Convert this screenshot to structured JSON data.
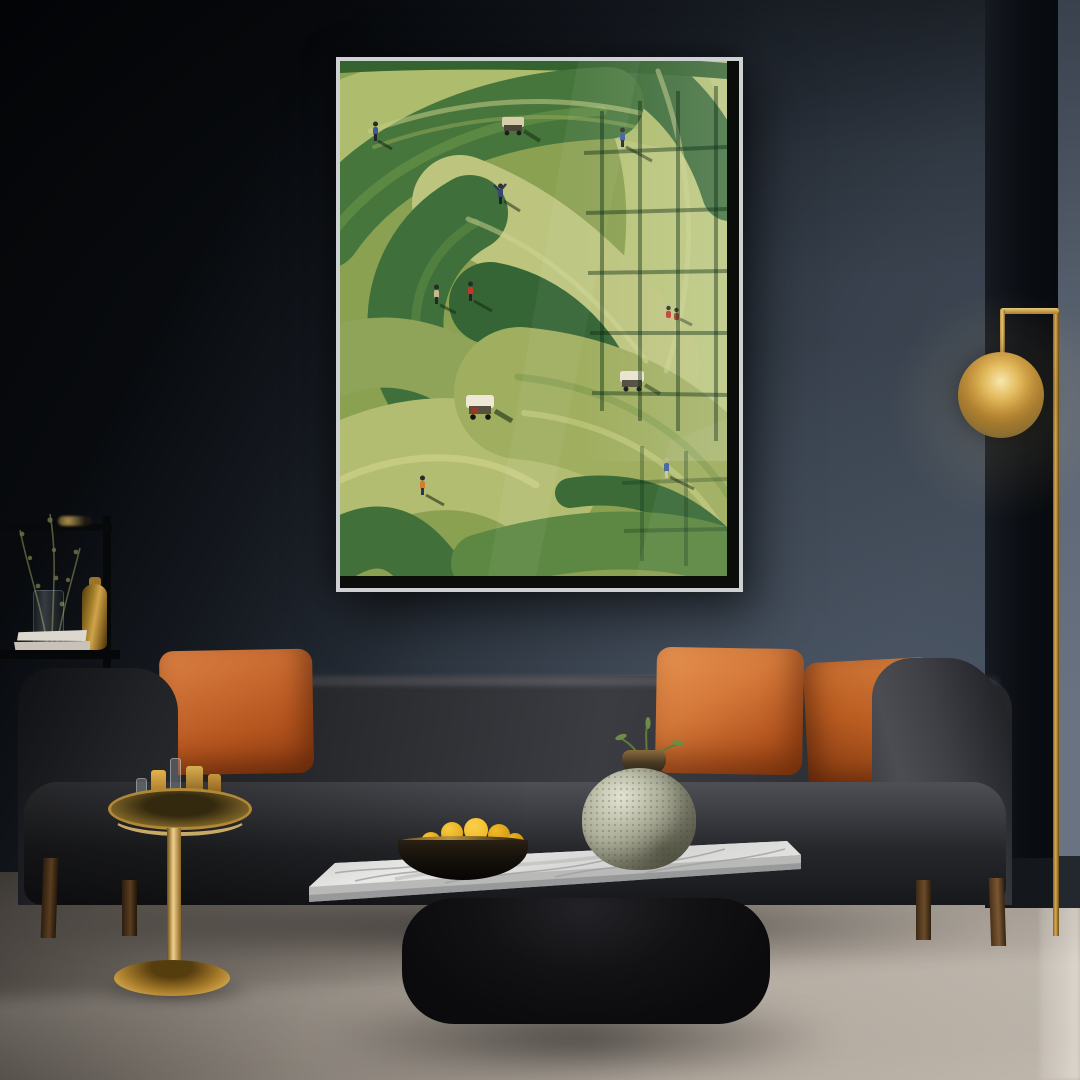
{
  "scene": {
    "type": "interior-photograph",
    "description": "Dark moody living room: framed textured painting of aerial golf-course green brushstrokes with miniature golfers and golf carts, hung on a dark slate wall above a charcoal sofa with four rust-orange pillows; brass globe floor lamp on the right; black shelf with gold vase, plant and white books on the left; gold pedestal side table with glass candle tray; marble-top coffee table on a black plinth holding a black bowl of yellow fruit and a speckled sage ceramic vase; beige carpet floor",
    "elements": [
      {
        "name": "artwork-frame",
        "label": "framed golf-course impasto painting"
      },
      {
        "name": "floor-lamp",
        "label": "brass globe floor lamp"
      },
      {
        "name": "shelf-unit",
        "label": "black shelf with gold vase, plant, books"
      },
      {
        "name": "sofa",
        "label": "charcoal fabric sofa with rust pillows"
      },
      {
        "name": "side-table",
        "label": "gold pedestal side table with tray"
      },
      {
        "name": "coffee-table",
        "label": "marble slab coffee table on black plinth"
      },
      {
        "name": "fruit-bowl",
        "label": "black bowl with yellow fruit"
      },
      {
        "name": "ceramic-vase",
        "label": "speckled sage round vase with green sprig"
      }
    ]
  },
  "artwork": {
    "motif": "aerial golf course made of thick green paint strokes",
    "golfer_count": 9,
    "golf_cart_count": 3,
    "reflection": "window grid glare on glass, upper right and lower right"
  },
  "palette": {
    "wall_base": "#3e4753",
    "panel_dark": "#0c0f14",
    "corner_wall": "#636c7a",
    "floor_base": "#a49b91",
    "frame_metal": "#cdd1d4",
    "frame_inner": "#0b0d0a",
    "art_base": "#8ba152",
    "art_green_dark": "#3f6f3a",
    "art_green_mid": "#5d8844",
    "art_olive": "#90a459",
    "art_light": "#aebc6e",
    "art_pale": "#bcc47e",
    "cart_body": "#e9e2cf",
    "golfer_red": "#c0392b",
    "golfer_blue": "#3a5a9c",
    "golfer_orange": "#d97b2a",
    "sofa_base": "#232428",
    "pillow_main": "#b4541e",
    "pillow_light": "#dd8244",
    "pillow_dark": "#7c350f",
    "leg_wood": "#6b4a2a",
    "brass": "#c79a3f",
    "marble_light": "#e8e8e6",
    "marble_shadow": "#9fa1a2",
    "plinth": "#0b0b0d",
    "bowl_black": "#16110b",
    "fruit": "#efb21b",
    "vase_body": "#adb09a",
    "vase_neck": "#463824",
    "sprig": "#5d7c3a",
    "gold_vase": "#d0a44b",
    "book_top": "#ddd8cf",
    "book_bottom": "#c8c2b8"
  }
}
